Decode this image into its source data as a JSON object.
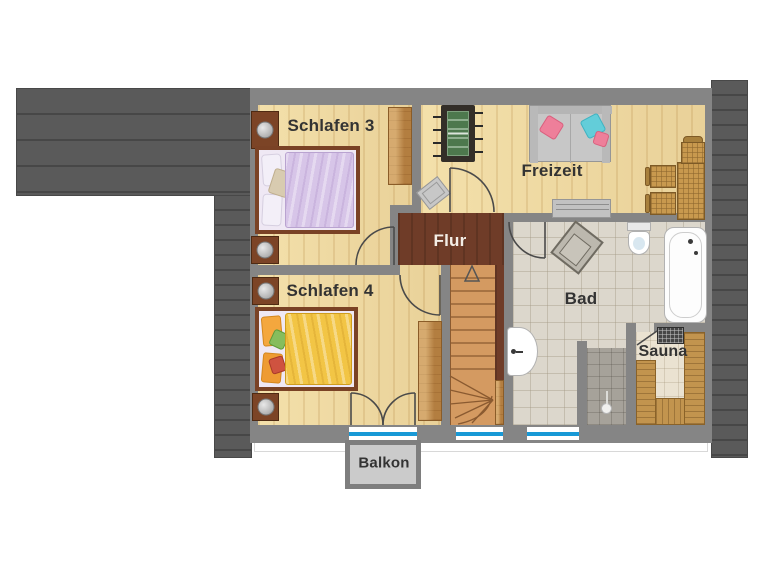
{
  "plan": {
    "rooms": {
      "schlafen3": "Schlafen 3",
      "schlafen4": "Schlafen 4",
      "freizeit": "Freizeit",
      "flur": "Flur",
      "bad": "Bad",
      "sauna": "Sauna",
      "balkon": "Balkon"
    },
    "colors": {
      "roof": "#5a5a5a",
      "wall": "#858585",
      "wood_floor": "#eed9a2",
      "hall_floor": "#6f3c28",
      "stairs": "#d49a61",
      "bathroom_tile": "#dcd7cc",
      "shower_tile": "#a6a29a",
      "sauna_bench": "#c2944e",
      "window_glass": "#1899d6",
      "balcony": "#cbcbcb",
      "bed1_blanket": "#d7c5e8",
      "bed2_blanket": "#f2c545"
    },
    "furniture": [
      "double-bed-lavender",
      "double-bed-yellow",
      "wardrobes",
      "nightstands",
      "foosball-table",
      "sofa-with-cushions",
      "desk-with-chairs",
      "sideboard",
      "bathtub",
      "toilet",
      "sink",
      "shower",
      "sauna-benches",
      "sauna-heater",
      "staircase-with-arrow"
    ]
  }
}
